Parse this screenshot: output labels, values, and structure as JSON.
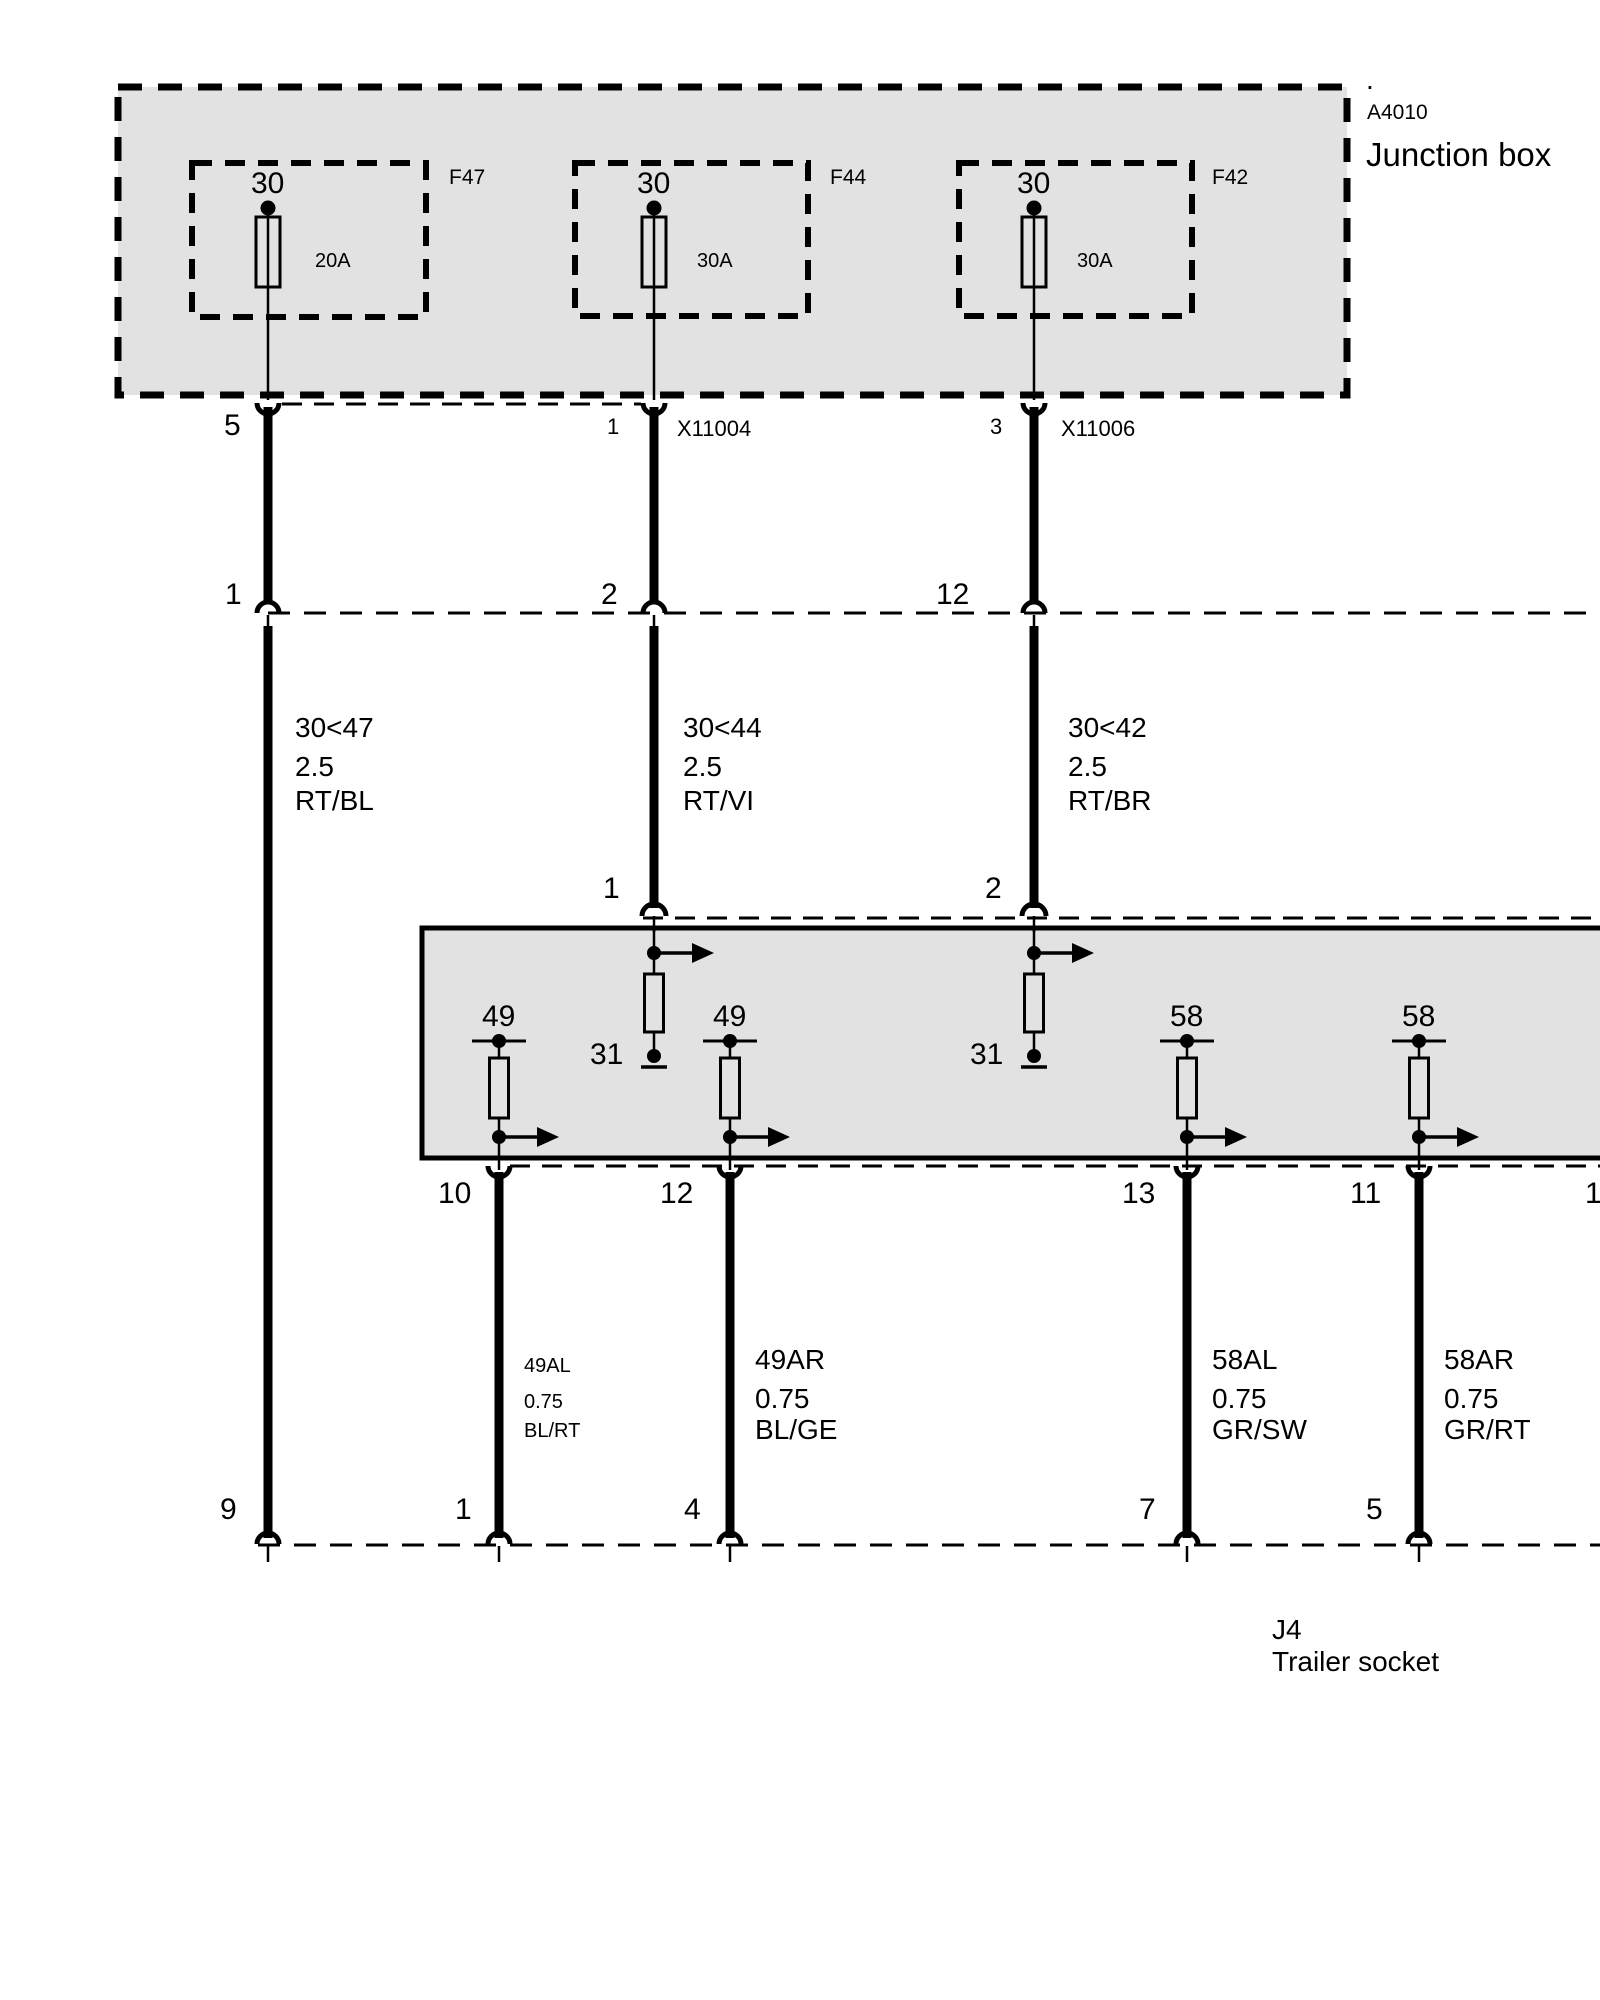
{
  "title_block": {
    "dot": ".",
    "component_id": "A4010",
    "component_name": "Junction box"
  },
  "fuses": [
    {
      "terminal": "30",
      "rating": "20A",
      "code": "F47"
    },
    {
      "terminal": "30",
      "rating": "30A",
      "code": "F44"
    },
    {
      "terminal": "30",
      "rating": "30A",
      "code": "F42"
    }
  ],
  "connector_row_top": {
    "pin_left": "5",
    "pin_mid": "1",
    "connector_mid": "X11004",
    "pin_right": "3",
    "connector_right": "X11006"
  },
  "connector_row_mid": {
    "pins": [
      "1",
      "2",
      "12"
    ]
  },
  "wires_upper": [
    {
      "circuit": "30<47",
      "gauge": "2.5",
      "color_code": "RT/BL"
    },
    {
      "circuit": "30<44",
      "gauge": "2.5",
      "color_code": "RT/VI"
    },
    {
      "circuit": "30<42",
      "gauge": "2.5",
      "color_code": "RT/BR"
    }
  ],
  "module": {
    "input_pins": [
      "1",
      "2"
    ],
    "ground_terminals": [
      "31",
      "31"
    ],
    "lamp_terminals": [
      "49",
      "49",
      "58",
      "58"
    ],
    "output_pins": [
      "10",
      "12",
      "13",
      "11",
      "1"
    ]
  },
  "wires_lower": [
    {
      "circuit": "49AL",
      "gauge": "0.75",
      "color_code": "BL/RT"
    },
    {
      "circuit": "49AR",
      "gauge": "0.75",
      "color_code": "BL/GE"
    },
    {
      "circuit": "58AL",
      "gauge": "0.75",
      "color_code": "GR/SW"
    },
    {
      "circuit": "58AR",
      "gauge": "0.75",
      "color_code": "GR/RT"
    }
  ],
  "socket_row": {
    "pins": [
      "9",
      "1",
      "4",
      "7",
      "5"
    ]
  },
  "socket": {
    "id": "J4",
    "name": "Trailer socket"
  },
  "colors": {
    "line": "#000000",
    "box_fill": "#e2e2e2",
    "background": "#ffffff"
  }
}
